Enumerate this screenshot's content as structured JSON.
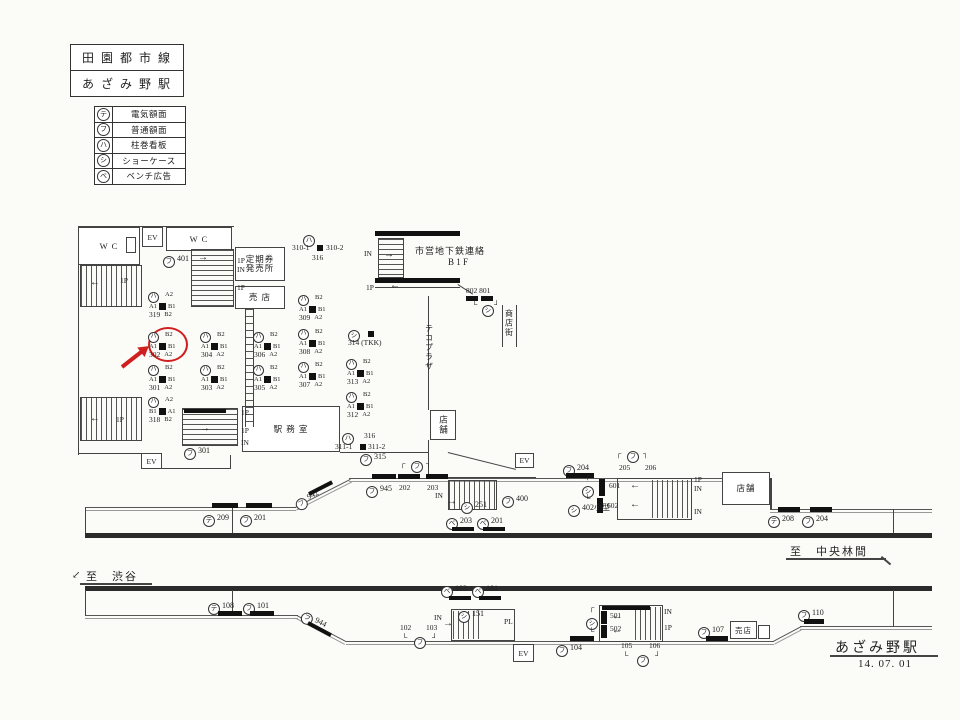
{
  "header": {
    "line_name": "田 園 都 市 線",
    "station_name": "あ ざ み 野 駅"
  },
  "legend": [
    {
      "sym": "テ",
      "label": "電気額面"
    },
    {
      "sym": "フ",
      "label": "普通額面"
    },
    {
      "sym": "ハ",
      "label": "柱巻看板"
    },
    {
      "sym": "シ",
      "label": "ショーケース"
    },
    {
      "sym": "ベ",
      "label": "ベンチ広告"
    }
  ],
  "rooms": {
    "wc_left": "W C",
    "wc_right": "W C",
    "ev_top": "EV",
    "ev_concourse": "EV",
    "ev_mid": "EV",
    "ev_bottom": "EV",
    "ticket_office_l1": "定期券",
    "ticket_office_l2": "発売所",
    "kiosk_upper": "売 店",
    "station_office": "駅 務 室",
    "shop_concourse": "店舗",
    "shop_mid": "店舗",
    "kiosk_lower": "売店",
    "teco_plaza": "テコプラザ",
    "shopping_street": "商店街",
    "subway_l1": "市営地下鉄連絡",
    "subway_l2": "B 1 F"
  },
  "footer": {
    "to_chuorinkan": "至　中央林間",
    "to_shibuya": "至　渋谷",
    "station_name": "あざみ野駅",
    "date": "14. 07. 01"
  },
  "accent_color": "#cf1f1f",
  "markers": [
    {
      "t": "circ",
      "x": 163,
      "y": 254,
      "sym": "フ",
      "label": "401"
    },
    {
      "t": "pil",
      "x": 148,
      "y": 291,
      "sym": "ハ",
      "num": "319",
      "top": "A2",
      "l": "A1",
      "r": "B1",
      "bot": "B2"
    },
    {
      "t": "pil",
      "x": 148,
      "y": 331,
      "sym": "ハ",
      "num": "302",
      "top": "B2",
      "l": "A1",
      "r": "B1",
      "bot": "A2"
    },
    {
      "t": "pil",
      "x": 148,
      "y": 364,
      "sym": "ハ",
      "num": "301",
      "top": "B2",
      "l": "A1",
      "r": "B1",
      "bot": "A2"
    },
    {
      "t": "pil",
      "x": 148,
      "y": 396,
      "sym": "ハ",
      "num": "318",
      "top": "A2",
      "l": "B1",
      "r": "A1",
      "bot": "B2"
    },
    {
      "t": "pil",
      "x": 200,
      "y": 331,
      "sym": "ハ",
      "num": "304",
      "top": "B2",
      "l": "A1",
      "r": "B1",
      "bot": "A2"
    },
    {
      "t": "pil",
      "x": 200,
      "y": 364,
      "sym": "ハ",
      "num": "303",
      "top": "B2",
      "l": "A1",
      "r": "B1",
      "bot": "A2"
    },
    {
      "t": "pil",
      "x": 253,
      "y": 331,
      "sym": "ハ",
      "num": "306",
      "top": "B2",
      "l": "A1",
      "r": "B1",
      "bot": "A2"
    },
    {
      "t": "pil",
      "x": 253,
      "y": 364,
      "sym": "ハ",
      "num": "305",
      "top": "B2",
      "l": "A1",
      "r": "B1",
      "bot": "A2"
    },
    {
      "t": "pil",
      "x": 298,
      "y": 294,
      "sym": "ハ",
      "num": "309",
      "top": "B2",
      "l": "A1",
      "r": "B1",
      "bot": "A2"
    },
    {
      "t": "pil",
      "x": 298,
      "y": 328,
      "sym": "ハ",
      "num": "308",
      "top": "B2",
      "l": "A1",
      "r": "B1",
      "bot": "A2"
    },
    {
      "t": "pil",
      "x": 298,
      "y": 361,
      "sym": "ハ",
      "num": "307",
      "top": "B2",
      "l": "A1",
      "r": "B1",
      "bot": "A2"
    },
    {
      "t": "pil",
      "x": 346,
      "y": 358,
      "sym": "ハ",
      "num": "313",
      "top": "B2",
      "l": "A1",
      "r": "B1",
      "bot": "A2"
    },
    {
      "t": "pil",
      "x": 346,
      "y": 391,
      "sym": "ハ",
      "num": "312",
      "top": "B2",
      "l": "A1",
      "r": "B1",
      "bot": "A2"
    },
    {
      "t": "circ",
      "x": 348,
      "y": 328,
      "sym": "シ",
      "label": ""
    },
    {
      "t": "bar",
      "x": 368,
      "y": 331,
      "w": 6,
      "h": 6
    },
    {
      "t": "txt",
      "x": 348,
      "y": 339,
      "label": "314 (TKK)"
    },
    {
      "t": "circ",
      "x": 303,
      "y": 233,
      "sym": "ハ",
      "label": ""
    },
    {
      "t": "txt",
      "x": 292,
      "y": 244,
      "label": "310-1"
    },
    {
      "t": "bar",
      "x": 317,
      "y": 245,
      "w": 6,
      "h": 6
    },
    {
      "t": "txt",
      "x": 326,
      "y": 244,
      "label": "310-2"
    },
    {
      "t": "txt",
      "x": 312,
      "y": 254,
      "label": "316"
    },
    {
      "t": "circ",
      "x": 342,
      "y": 431,
      "sym": "ハ",
      "label": ""
    },
    {
      "t": "txt",
      "x": 364,
      "y": 432,
      "label": "316"
    },
    {
      "t": "txt",
      "x": 335,
      "y": 443,
      "label": "311-1"
    },
    {
      "t": "bar",
      "x": 360,
      "y": 444,
      "w": 6,
      "h": 6
    },
    {
      "t": "txt",
      "x": 368,
      "y": 443,
      "label": "311-2"
    },
    {
      "t": "circ",
      "x": 360,
      "y": 452,
      "sym": "フ",
      "label": "315"
    },
    {
      "t": "txt",
      "x": 466,
      "y": 287,
      "label": "802 801"
    },
    {
      "t": "bar",
      "x": 466,
      "y": 296,
      "w": 12,
      "h": 5
    },
    {
      "t": "bar",
      "x": 481,
      "y": 296,
      "w": 12,
      "h": 5
    },
    {
      "t": "txt",
      "x": 472,
      "y": 301,
      "label": "└"
    },
    {
      "t": "circ",
      "x": 482,
      "y": 303,
      "sym": "シ",
      "label": ""
    },
    {
      "t": "txt",
      "x": 494,
      "y": 301,
      "label": "┘"
    },
    {
      "t": "circ",
      "x": 184,
      "y": 446,
      "sym": "フ",
      "label": "301"
    },
    {
      "t": "txt",
      "x": 120,
      "y": 277,
      "label": "1P"
    },
    {
      "t": "txt",
      "x": 90,
      "y": 278,
      "label": "←",
      "cls": "ar"
    },
    {
      "t": "txt",
      "x": 116,
      "y": 416,
      "label": "1P"
    },
    {
      "t": "txt",
      "x": 90,
      "y": 414,
      "label": "←",
      "cls": "ar"
    },
    {
      "t": "txt",
      "x": 237,
      "y": 257,
      "label": "1P"
    },
    {
      "t": "txt",
      "x": 237,
      "y": 266,
      "label": "IN"
    },
    {
      "t": "txt",
      "x": 237,
      "y": 284,
      "label": "1P"
    },
    {
      "t": "txt",
      "x": 198,
      "y": 253,
      "label": "→",
      "cls": "ar"
    },
    {
      "t": "txt",
      "x": 364,
      "y": 250,
      "label": "IN"
    },
    {
      "t": "txt",
      "x": 384,
      "y": 250,
      "label": "→",
      "cls": "ar"
    },
    {
      "t": "txt",
      "x": 366,
      "y": 284,
      "label": "1P"
    },
    {
      "t": "txt",
      "x": 390,
      "y": 281,
      "label": "←",
      "cls": "ar"
    },
    {
      "t": "txt",
      "x": 241,
      "y": 409,
      "label": "1P"
    },
    {
      "t": "txt",
      "x": 241,
      "y": 427,
      "label": "1P"
    },
    {
      "t": "txt",
      "x": 241,
      "y": 439,
      "label": "IN"
    },
    {
      "t": "txt",
      "x": 200,
      "y": 424,
      "label": "→",
      "cls": "ar"
    },
    {
      "t": "circ",
      "x": 203,
      "y": 513,
      "sym": "テ",
      "label": "209"
    },
    {
      "t": "bar",
      "x": 212,
      "y": 503,
      "w": 26,
      "h": 5
    },
    {
      "t": "circ",
      "x": 240,
      "y": 513,
      "sym": "フ",
      "label": "201"
    },
    {
      "t": "bar",
      "x": 246,
      "y": 503,
      "w": 26,
      "h": 5
    },
    {
      "t": "circ",
      "x": 296,
      "y": 499,
      "sym": "フ",
      "label": "942",
      "rot": -27
    },
    {
      "t": "bar",
      "x": 309,
      "y": 492,
      "w": 26,
      "h": 4,
      "rot": -27
    },
    {
      "t": "circ",
      "x": 366,
      "y": 484,
      "sym": "フ",
      "label": "945"
    },
    {
      "t": "bar",
      "x": 372,
      "y": 474,
      "w": 24,
      "h": 5
    },
    {
      "t": "txt",
      "x": 400,
      "y": 460,
      "label": "┌"
    },
    {
      "t": "circ",
      "x": 411,
      "y": 459,
      "sym": "フ",
      "label": ""
    },
    {
      "t": "txt",
      "x": 426,
      "y": 460,
      "label": "┐"
    },
    {
      "t": "bar",
      "x": 398,
      "y": 474,
      "w": 22,
      "h": 5
    },
    {
      "t": "bar",
      "x": 426,
      "y": 474,
      "w": 22,
      "h": 5
    },
    {
      "t": "txt",
      "x": 399,
      "y": 484,
      "label": "202"
    },
    {
      "t": "txt",
      "x": 427,
      "y": 484,
      "label": "203"
    },
    {
      "t": "txt",
      "x": 435,
      "y": 492,
      "label": "IN"
    },
    {
      "t": "txt",
      "x": 447,
      "y": 497,
      "label": "→",
      "cls": "ar"
    },
    {
      "t": "circ",
      "x": 461,
      "y": 500,
      "sym": "シ",
      "label": "251"
    },
    {
      "t": "circ",
      "x": 446,
      "y": 516,
      "sym": "ベ",
      "label": "203"
    },
    {
      "t": "bar",
      "x": 452,
      "y": 527,
      "w": 22,
      "h": 4
    },
    {
      "t": "circ",
      "x": 477,
      "y": 516,
      "sym": "ベ",
      "label": "201"
    },
    {
      "t": "bar",
      "x": 483,
      "y": 527,
      "w": 22,
      "h": 4
    },
    {
      "t": "circ",
      "x": 502,
      "y": 494,
      "sym": "フ",
      "label": "400"
    },
    {
      "t": "circ",
      "x": 563,
      "y": 463,
      "sym": "フ",
      "label": "204"
    },
    {
      "t": "bar",
      "x": 566,
      "y": 473,
      "w": 28,
      "h": 5
    },
    {
      "t": "txt",
      "x": 616,
      "y": 450,
      "label": "┌"
    },
    {
      "t": "circ",
      "x": 627,
      "y": 449,
      "sym": "フ",
      "label": ""
    },
    {
      "t": "txt",
      "x": 643,
      "y": 450,
      "label": "┐"
    },
    {
      "t": "txt",
      "x": 619,
      "y": 464,
      "label": "205"
    },
    {
      "t": "txt",
      "x": 645,
      "y": 464,
      "label": "206"
    },
    {
      "t": "txt",
      "x": 585,
      "y": 472,
      "label": "┌"
    },
    {
      "t": "circ",
      "x": 582,
      "y": 484,
      "sym": "シ",
      "label": ""
    },
    {
      "t": "txt",
      "x": 585,
      "y": 495,
      "label": "└"
    },
    {
      "t": "bar",
      "x": 599,
      "y": 479,
      "w": 6,
      "h": 17
    },
    {
      "t": "bar",
      "x": 597,
      "y": 498,
      "w": 6,
      "h": 15
    },
    {
      "t": "txt",
      "x": 609,
      "y": 482,
      "label": "601"
    },
    {
      "t": "txt",
      "x": 607,
      "y": 502,
      "label": "602"
    },
    {
      "t": "circ",
      "x": 568,
      "y": 503,
      "sym": "シ",
      "label": "402小型"
    },
    {
      "t": "txt",
      "x": 694,
      "y": 476,
      "label": "1P"
    },
    {
      "t": "txt",
      "x": 694,
      "y": 485,
      "label": "IN"
    },
    {
      "t": "txt",
      "x": 694,
      "y": 508,
      "label": "IN"
    },
    {
      "t": "txt",
      "x": 630,
      "y": 481,
      "label": "←",
      "cls": "ar"
    },
    {
      "t": "txt",
      "x": 630,
      "y": 500,
      "label": "←",
      "cls": "ar"
    },
    {
      "t": "circ",
      "x": 768,
      "y": 514,
      "sym": "テ",
      "label": "208"
    },
    {
      "t": "bar",
      "x": 778,
      "y": 507,
      "w": 22,
      "h": 5
    },
    {
      "t": "circ",
      "x": 802,
      "y": 514,
      "sym": "フ",
      "label": "204"
    },
    {
      "t": "bar",
      "x": 810,
      "y": 507,
      "w": 22,
      "h": 5
    },
    {
      "t": "circ",
      "x": 208,
      "y": 601,
      "sym": "テ",
      "label": "108"
    },
    {
      "t": "bar",
      "x": 218,
      "y": 611,
      "w": 24,
      "h": 5
    },
    {
      "t": "circ",
      "x": 243,
      "y": 601,
      "sym": "フ",
      "label": "101"
    },
    {
      "t": "bar",
      "x": 250,
      "y": 611,
      "w": 24,
      "h": 5
    },
    {
      "t": "circ",
      "x": 302,
      "y": 608,
      "sym": "フ",
      "label": "944",
      "rot": 28
    },
    {
      "t": "bar",
      "x": 308,
      "y": 621,
      "w": 26,
      "h": 4,
      "rot": 28
    },
    {
      "t": "txt",
      "x": 400,
      "y": 624,
      "label": "102"
    },
    {
      "t": "txt",
      "x": 426,
      "y": 624,
      "label": "103"
    },
    {
      "t": "txt",
      "x": 402,
      "y": 634,
      "label": "└"
    },
    {
      "t": "circ",
      "x": 414,
      "y": 635,
      "sym": "フ",
      "label": ""
    },
    {
      "t": "txt",
      "x": 432,
      "y": 634,
      "label": "┘"
    },
    {
      "t": "circ",
      "x": 441,
      "y": 584,
      "sym": "ベ",
      "label": "103"
    },
    {
      "t": "bar",
      "x": 449,
      "y": 596,
      "w": 22,
      "h": 4
    },
    {
      "t": "circ",
      "x": 472,
      "y": 584,
      "sym": "ベ",
      "label": "101"
    },
    {
      "t": "bar",
      "x": 479,
      "y": 596,
      "w": 22,
      "h": 4
    },
    {
      "t": "txt",
      "x": 434,
      "y": 614,
      "label": "IN"
    },
    {
      "t": "txt",
      "x": 443,
      "y": 619,
      "label": "→",
      "cls": "ar"
    },
    {
      "t": "circ",
      "x": 458,
      "y": 609,
      "sym": "シ",
      "label": "151"
    },
    {
      "t": "txt",
      "x": 504,
      "y": 618,
      "label": "PL"
    },
    {
      "t": "circ",
      "x": 556,
      "y": 643,
      "sym": "フ",
      "label": "104"
    },
    {
      "t": "bar",
      "x": 570,
      "y": 636,
      "w": 24,
      "h": 5
    },
    {
      "t": "txt",
      "x": 589,
      "y": 604,
      "label": "┌"
    },
    {
      "t": "circ",
      "x": 586,
      "y": 616,
      "sym": "シ",
      "label": ""
    },
    {
      "t": "txt",
      "x": 589,
      "y": 628,
      "label": "└"
    },
    {
      "t": "bar",
      "x": 601,
      "y": 611,
      "w": 6,
      "h": 13
    },
    {
      "t": "bar",
      "x": 601,
      "y": 625,
      "w": 6,
      "h": 13
    },
    {
      "t": "txt",
      "x": 610,
      "y": 612,
      "label": "501"
    },
    {
      "t": "txt",
      "x": 610,
      "y": 625,
      "label": "502"
    },
    {
      "t": "txt",
      "x": 664,
      "y": 608,
      "label": "IN"
    },
    {
      "t": "txt",
      "x": 664,
      "y": 624,
      "label": "1P"
    },
    {
      "t": "txt",
      "x": 612,
      "y": 612,
      "label": "←",
      "cls": "ar"
    },
    {
      "t": "txt",
      "x": 612,
      "y": 626,
      "label": "←",
      "cls": "ar"
    },
    {
      "t": "txt",
      "x": 621,
      "y": 642,
      "label": "105"
    },
    {
      "t": "txt",
      "x": 649,
      "y": 642,
      "label": "106"
    },
    {
      "t": "txt",
      "x": 623,
      "y": 652,
      "label": "└"
    },
    {
      "t": "circ",
      "x": 637,
      "y": 653,
      "sym": "フ",
      "label": ""
    },
    {
      "t": "txt",
      "x": 655,
      "y": 652,
      "label": "┘"
    },
    {
      "t": "circ",
      "x": 698,
      "y": 625,
      "sym": "フ",
      "label": "107"
    },
    {
      "t": "bar",
      "x": 706,
      "y": 636,
      "w": 22,
      "h": 5
    },
    {
      "t": "circ",
      "x": 798,
      "y": 608,
      "sym": "フ",
      "label": "110"
    },
    {
      "t": "bar",
      "x": 804,
      "y": 619,
      "w": 20,
      "h": 5
    },
    {
      "t": "txt",
      "x": 72,
      "y": 571,
      "label": "↙",
      "cls": "ar"
    }
  ]
}
